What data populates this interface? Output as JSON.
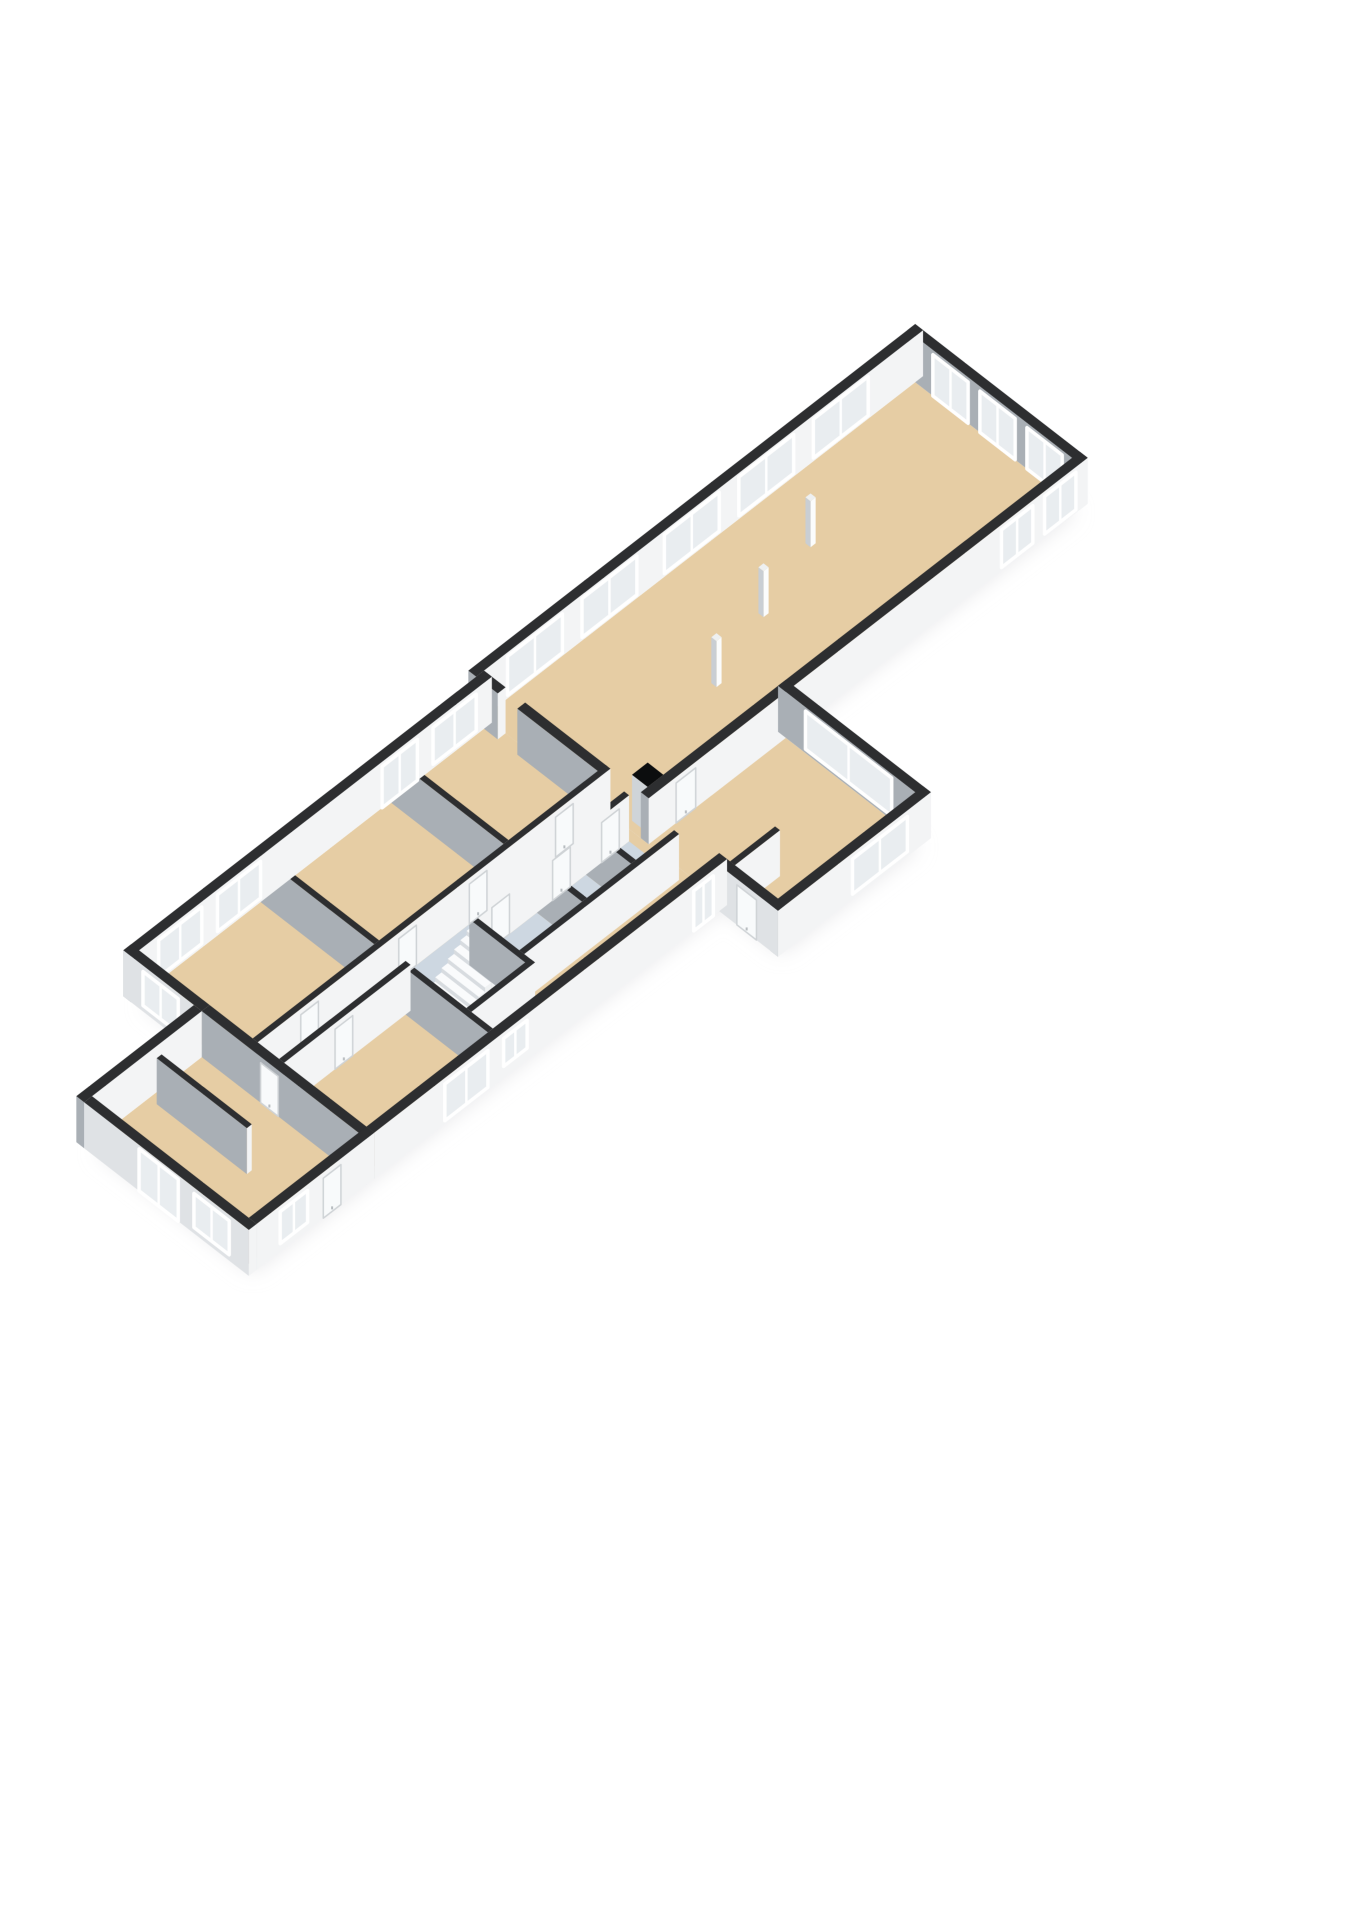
{
  "app": {
    "title": "3D floor plan view",
    "view": "isometric-floorplan"
  },
  "canvas": {
    "width": 1358,
    "height": 1920,
    "background": "#ffffff"
  },
  "floorplan": {
    "projection": {
      "kx": 19.6,
      "ky": 15.2,
      "kz": 40,
      "center": [
        582,
        800
      ],
      "wall_height": 1.15
    },
    "colors": {
      "background": "#ffffff",
      "floor": "#e6cda4",
      "wetFloor": "#cdd7e1",
      "wallTop": "#2d2e30",
      "wallSE": "#f3f4f5",
      "wallSW": "#a9afb5",
      "wallSWExterior": "#dfe2e5",
      "glass": "#e9edf0",
      "frame": "#ffffff",
      "doorLeaf": "#f8fafb",
      "doorStroke": "#cfd3d6",
      "shadow": "#dfe0e2",
      "stepTop": "#fafbfc",
      "stepSE": "#f0f2f3",
      "stepSW": "#d8dce0"
    },
    "shadow_blocks": [
      [
        24,
        0,
        46,
        8
      ],
      [
        6,
        0.4,
        24,
        12
      ],
      [
        24,
        8,
        31,
        15
      ],
      [
        0,
        4,
        6,
        12
      ]
    ],
    "floors": [
      {
        "name": "floor-hall",
        "rect": [
          24,
          0,
          46,
          8
        ],
        "color": "floor"
      },
      {
        "name": "floor-midwing",
        "rect": [
          6,
          0.4,
          24,
          12
        ],
        "color": "floor"
      },
      {
        "name": "floor-garden-room",
        "rect": [
          24,
          8,
          31,
          15
        ],
        "color": "floor"
      },
      {
        "name": "floor-annex",
        "rect": [
          0,
          4,
          6,
          12
        ],
        "color": "floor"
      },
      {
        "name": "floor-bathroom-1",
        "rect": [
          15.8,
          7.8,
          18.9,
          10.1
        ],
        "color": "wetFloor"
      },
      {
        "name": "floor-bathroom-2",
        "rect": [
          19.15,
          7.8,
          21.4,
          10.1
        ],
        "color": "wetFloor"
      },
      {
        "name": "floor-bathroom-3",
        "rect": [
          21.65,
          7.8,
          23.6,
          10.1
        ],
        "color": "wetFloor"
      },
      {
        "name": "floor-landing",
        "rect": [
          13.4,
          6.45,
          17,
          7.55
        ],
        "color": "wetFloor"
      }
    ],
    "walls": [
      {
        "name": "wall-hall-nw",
        "rect": [
          23.6,
          -0.4,
          46.4,
          0
        ],
        "openings": [
          {
            "face": "se",
            "span": [
              25.2,
              28.0
            ],
            "sill": 0.08,
            "top": 1.05,
            "type": "window"
          },
          {
            "face": "se",
            "span": [
              29.0,
              31.8
            ],
            "sill": 0.08,
            "top": 1.05,
            "type": "window"
          },
          {
            "face": "se",
            "span": [
              33.2,
              36.0
            ],
            "sill": 0.08,
            "top": 1.05,
            "type": "window"
          },
          {
            "face": "se",
            "span": [
              37.0,
              39.8
            ],
            "sill": 0.08,
            "top": 1.05,
            "type": "window"
          },
          {
            "face": "se",
            "span": [
              40.8,
              43.6
            ],
            "sill": 0.08,
            "top": 1.05,
            "type": "window"
          }
        ]
      },
      {
        "name": "wall-hall-ne",
        "rect": [
          46,
          -0.4,
          46.4,
          8.4
        ],
        "openings": [
          {
            "face": "sw",
            "span": [
              0.9,
              2.7
            ],
            "sill": 0,
            "top": 1.03,
            "type": "door-glass"
          },
          {
            "face": "sw",
            "span": [
              3.3,
              5.1
            ],
            "sill": 0,
            "top": 1.03,
            "type": "door-glass"
          },
          {
            "face": "sw",
            "span": [
              5.7,
              7.5
            ],
            "sill": 0,
            "top": 1.03,
            "type": "door-glass"
          }
        ]
      },
      {
        "name": "wall-hall-se",
        "rect": [
          24,
          8,
          46.4,
          8.4
        ],
        "openings": [
          {
            "face": "se",
            "span": [
              25.4,
              26.4
            ],
            "sill": 0,
            "top": 1.0,
            "type": "door"
          },
          {
            "face": "se",
            "span": [
              42.0,
              43.6
            ],
            "sill": 0.08,
            "top": 1.02,
            "type": "window"
          },
          {
            "face": "se",
            "span": [
              44.2,
              45.8
            ],
            "sill": 0.08,
            "top": 1.02,
            "type": "window"
          }
        ]
      },
      {
        "name": "wall-midwing-nw",
        "rect": [
          5.6,
          0,
          24,
          0.4
        ],
        "openings": [
          {
            "face": "se",
            "span": [
              7.0,
              9.2
            ],
            "sill": 0.1,
            "top": 1.02,
            "type": "window"
          },
          {
            "face": "se",
            "span": [
              10.0,
              12.2
            ],
            "sill": 0.1,
            "top": 1.02,
            "type": "window"
          },
          {
            "face": "se",
            "span": [
              18.4,
              20.2
            ],
            "sill": 0,
            "top": 1.03,
            "type": "door-glass"
          },
          {
            "face": "se",
            "span": [
              21.0,
              23.2
            ],
            "sill": 0.1,
            "top": 1.02,
            "type": "window"
          }
        ]
      },
      {
        "name": "wall-midwing-sw",
        "rect": [
          5.6,
          0,
          6,
          4
        ],
        "swExterior": true,
        "openings": [
          {
            "face": "sw",
            "span": [
              1.0,
              2.8
            ],
            "sill": 0.15,
            "top": 1.0,
            "type": "window"
          }
        ]
      },
      {
        "name": "wall-midwing-se",
        "rect": [
          6,
          12,
          24,
          12.4
        ],
        "openings": [
          {
            "face": "se",
            "span": [
              9.6,
              11.8
            ],
            "sill": 0.08,
            "top": 1.0,
            "type": "window"
          },
          {
            "face": "se",
            "span": [
              12.6,
              13.8
            ],
            "sill": 0.3,
            "top": 1.0,
            "type": "window"
          },
          {
            "face": "se",
            "span": [
              22.3,
              23.3
            ],
            "sill": 0,
            "top": 1.0,
            "type": "door-glass"
          }
        ]
      },
      {
        "name": "wall-annex-sw",
        "rect": [
          -0.4,
          4,
          0,
          12.4
        ],
        "swExterior": true,
        "openings": [
          {
            "face": "sw",
            "span": [
              6.8,
              8.8
            ],
            "sill": 0,
            "top": 1.05,
            "type": "door-glass"
          },
          {
            "face": "sw",
            "span": [
              9.6,
              11.4
            ],
            "sill": 0.15,
            "top": 1.0,
            "type": "window"
          }
        ]
      },
      {
        "name": "wall-annex-nw",
        "rect": [
          -0.4,
          3.6,
          5.6,
          4
        ],
        "openings": []
      },
      {
        "name": "wall-annex-se",
        "rect": [
          0,
          12,
          6,
          12.4
        ],
        "openings": [
          {
            "face": "se",
            "span": [
              1.2,
              2.6
            ],
            "sill": 0.2,
            "top": 1.0,
            "type": "window"
          },
          {
            "face": "se",
            "span": [
              3.4,
              4.3
            ],
            "sill": 0,
            "top": 1.0,
            "type": "door"
          }
        ]
      },
      {
        "name": "wall-garden-room-ne",
        "rect": [
          31,
          8,
          31.4,
          15.4
        ],
        "openings": [
          {
            "face": "sw",
            "span": [
              9.4,
              13.8
            ],
            "sill": 0.1,
            "top": 1.05,
            "type": "window"
          }
        ]
      },
      {
        "name": "wall-garden-room-se",
        "rect": [
          23.6,
          15,
          31.4,
          15.4
        ],
        "openings": [
          {
            "face": "se",
            "span": [
              27.4,
              30.2
            ],
            "sill": 0.12,
            "top": 1.0,
            "type": "window"
          }
        ]
      },
      {
        "name": "wall-garden-room-sw",
        "rect": [
          23.6,
          12.4,
          24,
          15.4
        ],
        "swExterior": true,
        "openings": [
          {
            "face": "sw",
            "span": [
              13.3,
              14.3
            ],
            "sill": 0,
            "top": 1.0,
            "type": "door"
          }
        ]
      },
      {
        "name": "wall-corridor-nw",
        "rect": [
          6,
          6.2,
          24,
          6.45
        ],
        "openings": [
          {
            "face": "se",
            "span": [
              8.2,
              9.1
            ],
            "sill": 0,
            "top": 1.0,
            "type": "door"
          },
          {
            "face": "se",
            "span": [
              13.2,
              14.1
            ],
            "sill": 0,
            "top": 1.0,
            "type": "door"
          },
          {
            "face": "se",
            "span": [
              16.8,
              17.7
            ],
            "sill": 0,
            "top": 1.0,
            "type": "door"
          },
          {
            "face": "se",
            "span": [
              21.2,
              22.1
            ],
            "sill": 0,
            "top": 1.0,
            "type": "door"
          }
        ]
      },
      {
        "name": "wall-corridor-se-west",
        "rect": [
          6,
          7.55,
          12.45,
          7.8
        ],
        "openings": [
          {
            "face": "se",
            "span": [
              8.6,
              9.5
            ],
            "sill": 0,
            "top": 1.0,
            "type": "door"
          }
        ]
      },
      {
        "name": "wall-corridor-se-east",
        "rect": [
          15.7,
          7.55,
          23.6,
          7.8
        ],
        "openings": [
          {
            "face": "se",
            "span": [
              16.6,
              17.5
            ],
            "sill": 0,
            "top": 1.0,
            "type": "door"
          },
          {
            "face": "se",
            "span": [
              19.7,
              20.6
            ],
            "sill": 0,
            "top": 1.0,
            "type": "door"
          },
          {
            "face": "se",
            "span": [
              22.2,
              23.1
            ],
            "sill": 0,
            "top": 1.0,
            "type": "door"
          }
        ]
      },
      {
        "name": "wall-cross-west-nw",
        "rect": [
          12.2,
          0.4,
          12.45,
          6.2
        ],
        "openings": []
      },
      {
        "name": "wall-cross-west-se",
        "rect": [
          12.2,
          7.55,
          12.45,
          12
        ],
        "openings": []
      },
      {
        "name": "wall-cross-east-nw",
        "rect": [
          18.8,
          0.4,
          19.05,
          6.2
        ],
        "openings": []
      },
      {
        "name": "wall-bath-divider-1",
        "rect": [
          18.9,
          7.8,
          19.15,
          10.1
        ],
        "openings": []
      },
      {
        "name": "wall-bath-divider-2",
        "rect": [
          21.4,
          7.8,
          21.65,
          10.1
        ],
        "openings": []
      },
      {
        "name": "wall-bath-se",
        "rect": [
          15.7,
          10.1,
          23.6,
          10.35
        ],
        "openings": []
      },
      {
        "name": "wall-stairwell-east",
        "rect": [
          15.45,
          7.8,
          15.7,
          10.9
        ],
        "openings": []
      },
      {
        "name": "wall-stairwell-se",
        "rect": [
          12.45,
          10.65,
          15.7,
          10.9
        ],
        "openings": []
      },
      {
        "name": "wall-hall-sw-lower",
        "rect": [
          23.6,
          0,
          24,
          1.1
        ],
        "openings": []
      },
      {
        "name": "wall-hall-sw-upper",
        "rect": [
          23.6,
          2.1,
          24,
          6.3
        ],
        "openings": []
      },
      {
        "name": "wall-annex-divider",
        "rect": [
          2.9,
          4.4,
          3.15,
          9
        ],
        "openings": []
      },
      {
        "name": "wall-annex-east",
        "rect": [
          5.6,
          4,
          6,
          12.4
        ],
        "openings": [
          {
            "face": "sw",
            "span": [
              7.0,
              7.9
            ],
            "sill": 0,
            "top": 1.0,
            "type": "door"
          }
        ]
      },
      {
        "name": "wall-wc",
        "rect": [
          24,
          12.55,
          26.3,
          12.8
        ],
        "openings": []
      }
    ],
    "boxes": [
      {
        "name": "column-1",
        "rect": [
          30.9,
          4.7,
          31.16,
          4.96
        ],
        "h": 1.15,
        "top": "#eef0f1",
        "se": "#fbfcfc",
        "sw": "#c9ced3"
      },
      {
        "name": "column-2",
        "rect": [
          34.4,
          3.6,
          34.66,
          3.86
        ],
        "h": 1.15,
        "top": "#eef0f1",
        "se": "#fbfcfc",
        "sw": "#c9ced3"
      },
      {
        "name": "column-3",
        "rect": [
          37.9,
          2.5,
          38.16,
          2.76
        ],
        "h": 1.15,
        "top": "#eef0f1",
        "se": "#fbfcfc",
        "sw": "#c9ced3"
      },
      {
        "name": "toilet-1",
        "rect": [
          19.7,
          9.3,
          20.3,
          9.95
        ],
        "h": 0.3,
        "top": "#fdfdfd",
        "se": "#f1f3f4",
        "sw": "#dde1e4"
      },
      {
        "name": "toilet-2",
        "rect": [
          24.5,
          13.5,
          25.1,
          14.15
        ],
        "h": 0.3,
        "top": "#fdfdfd",
        "se": "#f1f3f4",
        "sw": "#dde1e4"
      },
      {
        "name": "chimney",
        "rect": [
          24.35,
          7.2,
          25.15,
          8.0
        ],
        "h": 1.15,
        "top": "#0c0d0e",
        "se": "#f6f7f8",
        "sw": "#cfd4d8"
      }
    ],
    "stairs": {
      "name": "staircase",
      "u0": 12.55,
      "step_depth": 0.32,
      "count": 9,
      "v0": 8.0,
      "v1": 9.9,
      "h0": 0.18,
      "dh": 0.11
    }
  }
}
